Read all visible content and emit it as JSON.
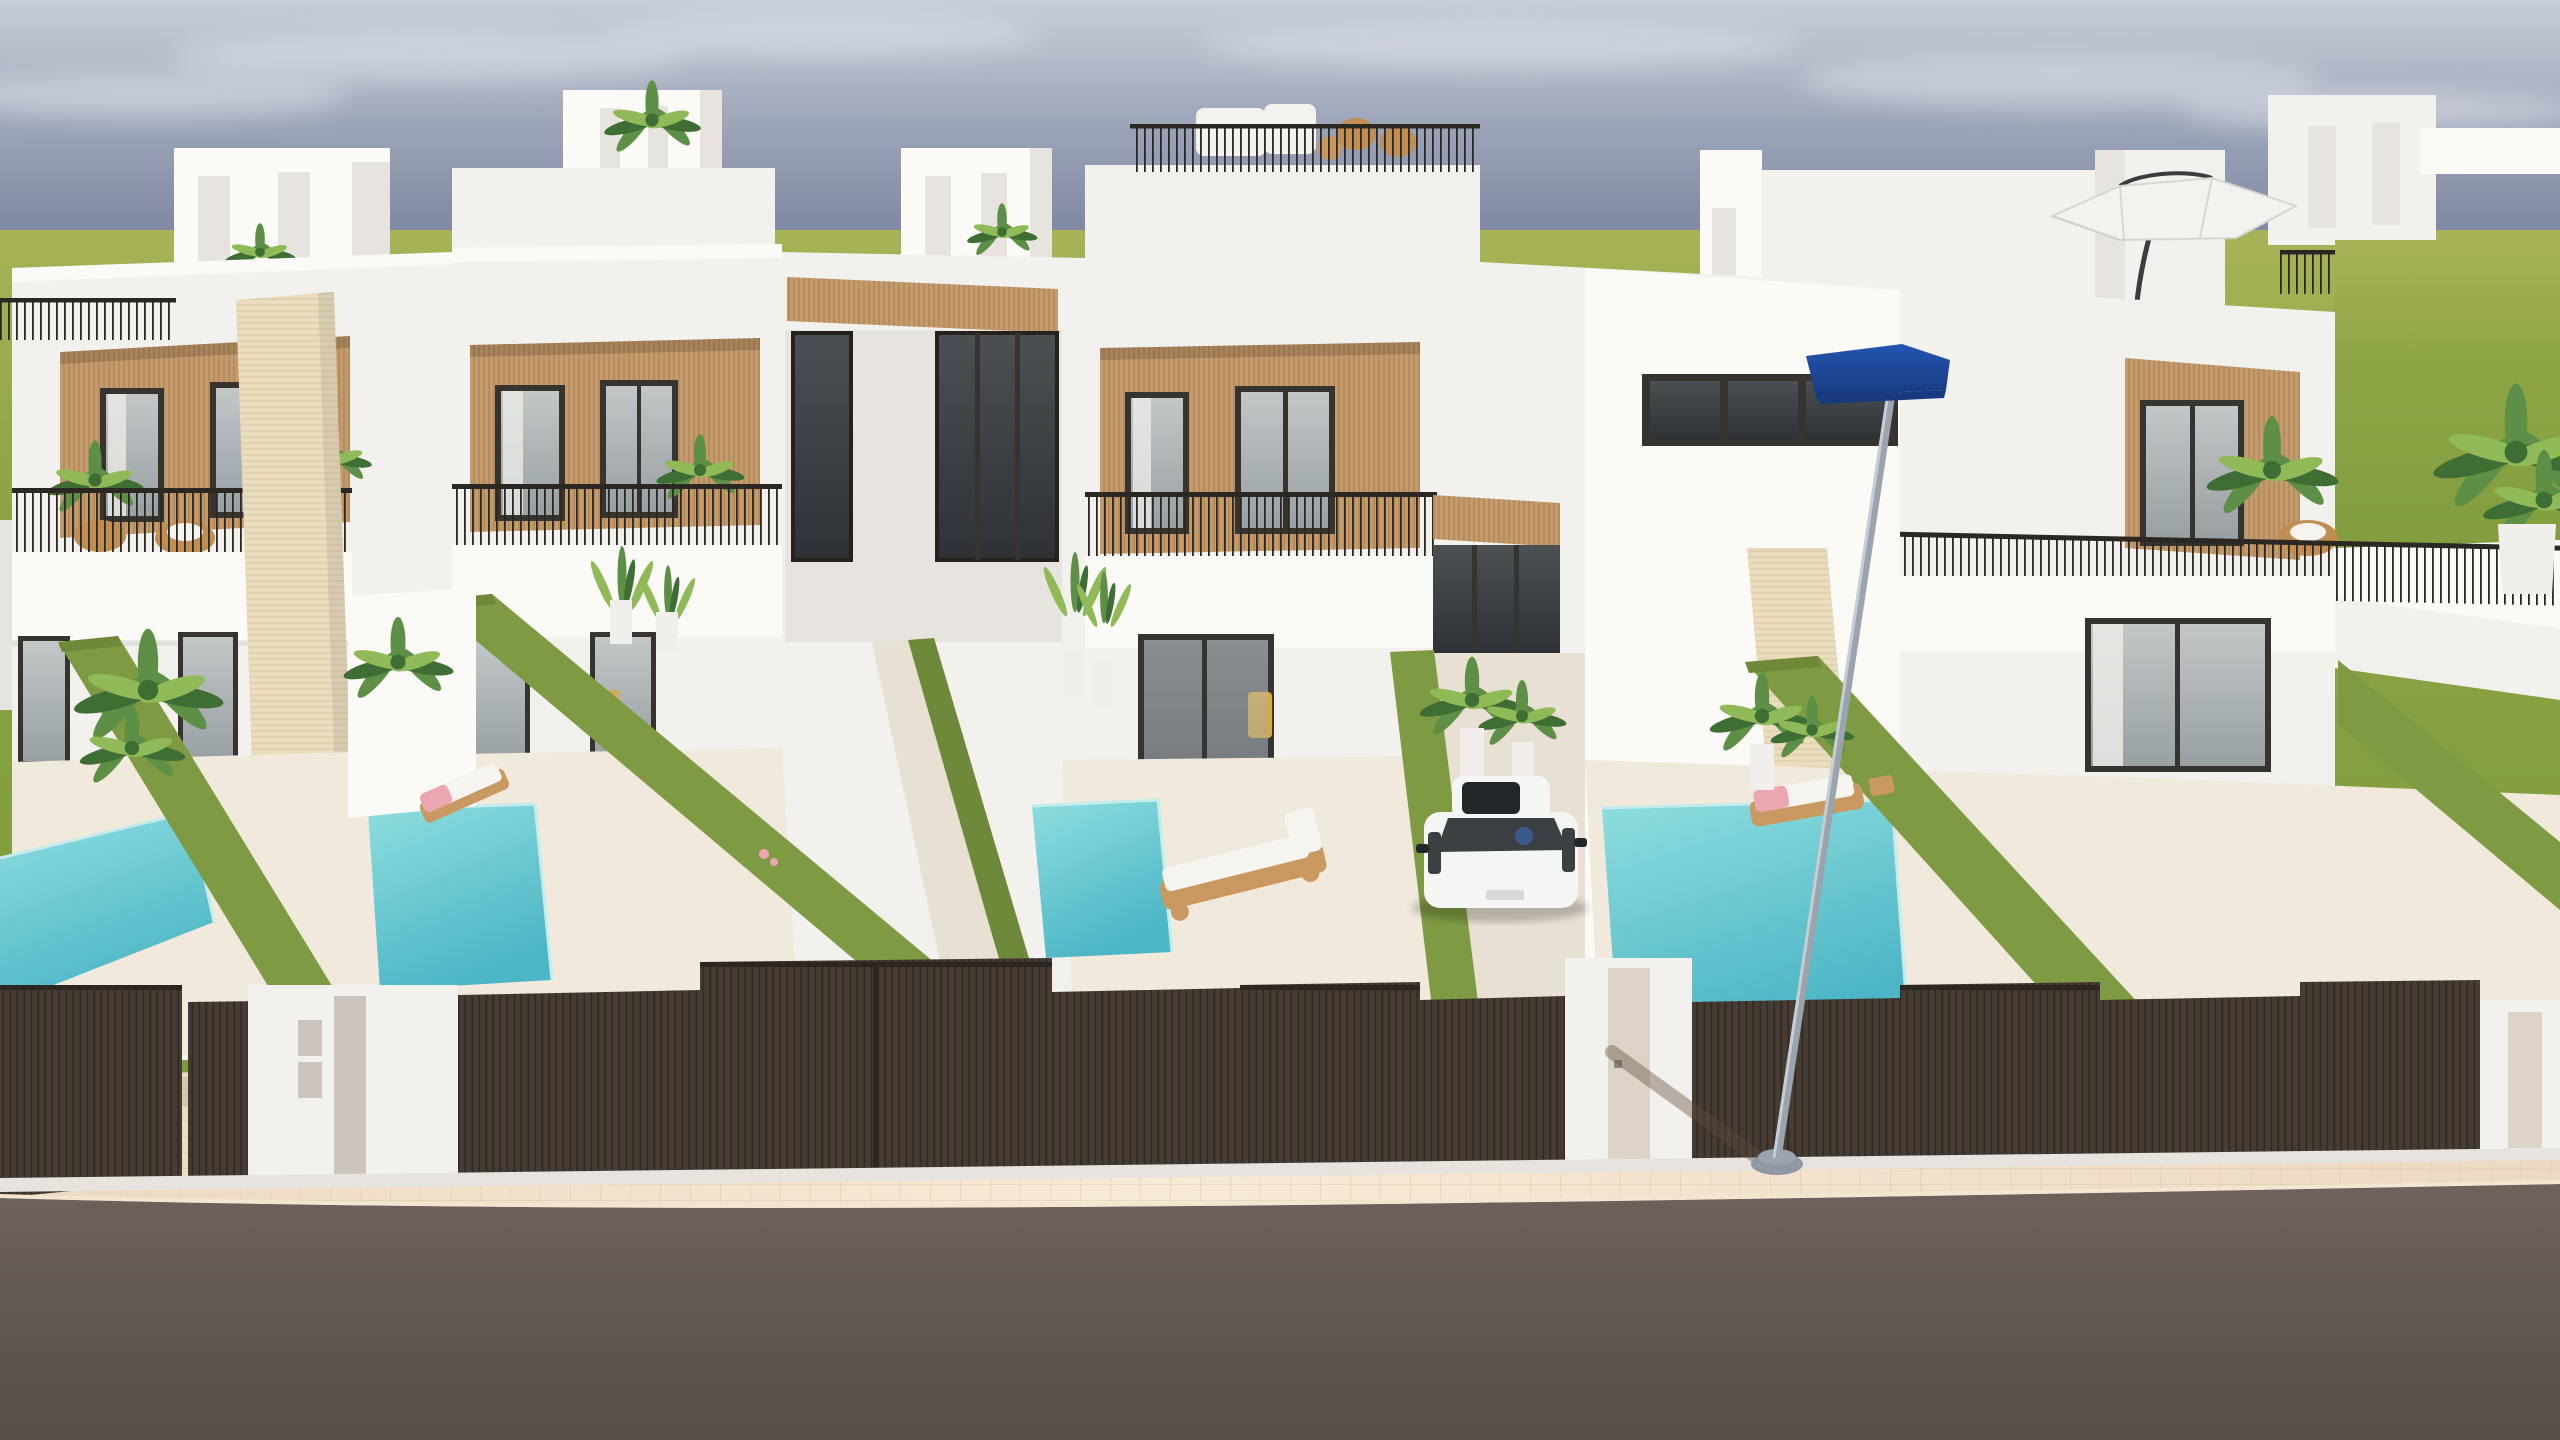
{
  "meta": {
    "title": "Architectural 3D render — row of modern townhouses with private pools",
    "type": "exterior-visualization",
    "time_of_day": "day"
  },
  "scene": {
    "units_visible": 4,
    "pools_visible": 4,
    "loungers_visible": 3,
    "landmarks": [
      "four white two-storey townhouses with rooftop terraces",
      "wood-slat recessed balconies with black railings",
      "turquoise private plunge pools",
      "artificial-grass privacy walls between yards",
      "dark brown slatted street gates and fences",
      "white entry pillars with letterbox panels",
      "white hatchback car parked in driveway",
      "street lamp with blue luminaire head",
      "white cantilever parasol on roof terrace",
      "beige paved sidewalk and asphalt road",
      "green field and hazy sky horizon"
    ]
  },
  "colors": {
    "sky_top": "#c8ced8",
    "sky_mid": "#9aa3b6",
    "sky_horizon": "#7d86a1",
    "cloud": "#dde1e8",
    "field_light": "#a9b257",
    "field_mid": "#8da545",
    "field_dark": "#7c993c",
    "white_sunlit": "#fbfaf7",
    "white_lit": "#f3f1ed",
    "white_shade": "#e7e3df",
    "white_shade_dark": "#d8d3ce",
    "wood": "#c49b6c",
    "wood_line": "#8a6238",
    "travertine": "#e9ddbe",
    "travertine_line": "#c9b68c",
    "frame_dark": "#37332e",
    "glass_light": "#c2c7c8",
    "glass_mid": "#99a0a3",
    "glass_dark": "#4b5053",
    "glass_darker": "#2e3236",
    "curtain": "#eceae6",
    "railing": "#2b2723",
    "hedge": "#7e9a43",
    "hedge_dark": "#6d8939",
    "pool_light": "#8fdede",
    "pool_deep": "#4db6c6",
    "pool_edge": "#c5ecec",
    "patio": "#f1e9db",
    "walkway": "#e8e1d3",
    "fence": "#463c33",
    "fence_dark": "#2d2620",
    "sidewalk": "#ecd9c2",
    "sidewalk_light": "#f7ead6",
    "sidewalk_line": "#d9bfa2",
    "road": "#6e635c",
    "road_dark": "#564e48",
    "curb": "#f2e6d2",
    "car_body": "#f5f5f3",
    "car_glass": "#3b4043",
    "car_detail": "#23272a",
    "lamp_pole": "#9aa3ae",
    "lamp_pole_light": "#c6cdd5",
    "lamp_head": "#2456b0",
    "lamp_head_dark": "#173a80",
    "lounger_wood": "#c89a62",
    "cushion": "#f6f4ef",
    "towel_pink": "#eba6b2",
    "accent_yellow": "#d9a93f",
    "plant": "#5d8f46",
    "plant_dark": "#3f6e35",
    "plant_light": "#8fba57",
    "rattan": "#c08d52",
    "sofa_white": "#f4f2ee",
    "door_panel_gray": "#ccc5bd",
    "door_panel_beige": "#ddd3c6",
    "pot_white": "#f1efeb",
    "interior_dark": "#5b6063"
  }
}
